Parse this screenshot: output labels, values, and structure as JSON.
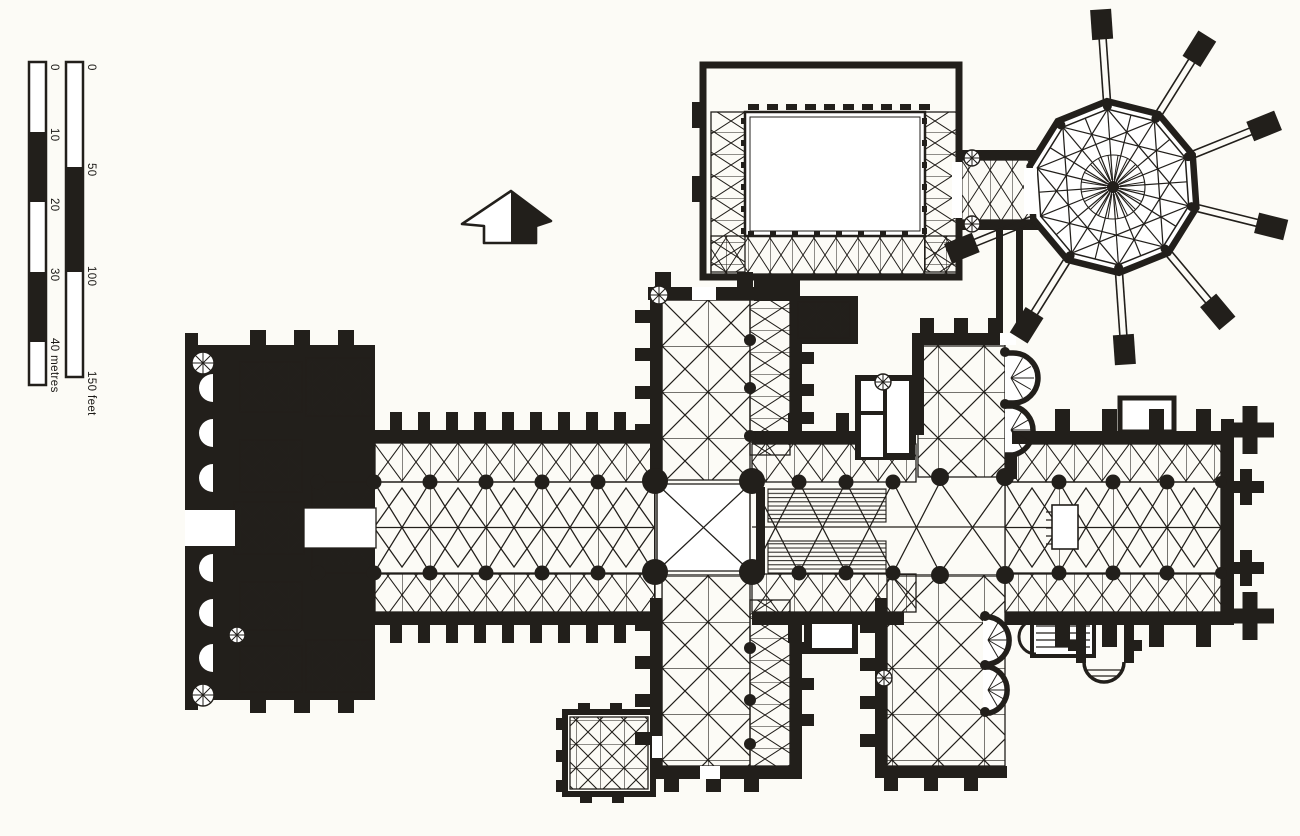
{
  "colors": {
    "ink": "#221f1b",
    "paper": "#fcfbf6",
    "plan_white": "#ffffff"
  },
  "scale_bars": {
    "metres": {
      "tick_labels": [
        "0",
        "10",
        "20",
        "30"
      ],
      "end_label": "40 metres"
    },
    "feet": {
      "tick_labels": [
        "0",
        "50",
        "100"
      ],
      "end_label": "150 feet"
    }
  },
  "compass": {
    "icon": "north-arrow"
  }
}
